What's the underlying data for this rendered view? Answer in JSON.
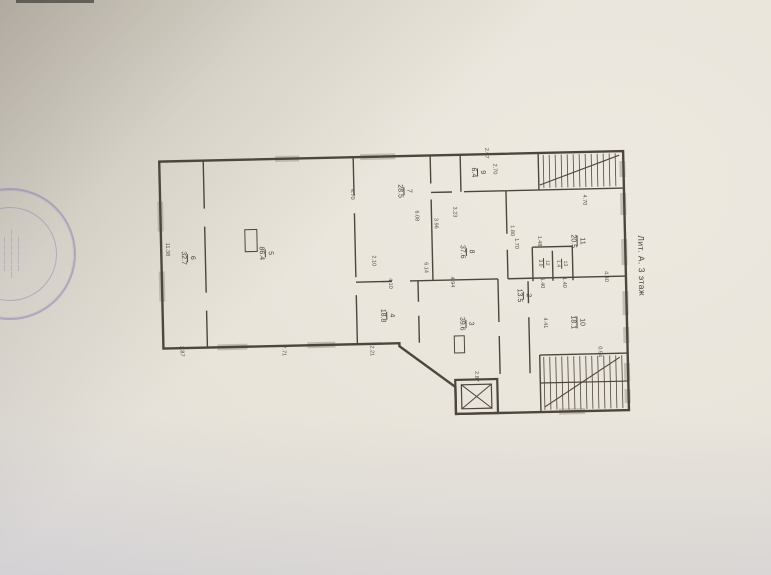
{
  "page": {
    "paper_color": "#e7e3d9",
    "line_color": "#4e463d",
    "stamp_color": "#8070ac"
  },
  "stamp": {
    "line1": "—————",
    "line2": "———————",
    "line3": "—————"
  },
  "plan": {
    "floor_label": "Лит. А. 3 этаж",
    "rooms": [
      {
        "number": "6",
        "area": "32.7"
      },
      {
        "number": "5",
        "area": "86.4"
      },
      {
        "number": "7",
        "area": "28.5"
      },
      {
        "number": "9",
        "area": "6.4"
      },
      {
        "number": "8",
        "area": "37.6"
      },
      {
        "number": "11",
        "area": "20.5"
      },
      {
        "number": "12",
        "area": "3.0"
      },
      {
        "number": "13",
        "area": "1.4"
      },
      {
        "number": "2",
        "area": "13.5"
      },
      {
        "number": "3",
        "area": "39.6"
      },
      {
        "number": "4",
        "area": "18.8"
      },
      {
        "number": "10",
        "area": "18.1"
      }
    ],
    "dimensions": [
      "11.38",
      "2.87",
      "7.71",
      "2.21",
      "4.70",
      "6.08",
      "3.96",
      "2.10",
      "6.14",
      "4.10",
      "4.94",
      "2.07",
      "2.70",
      "3.23",
      "1.80",
      "1.70",
      "4.70",
      "1.48",
      "1.40",
      "1.40",
      "4.40",
      "4.41",
      "0.94",
      "2.87"
    ]
  }
}
